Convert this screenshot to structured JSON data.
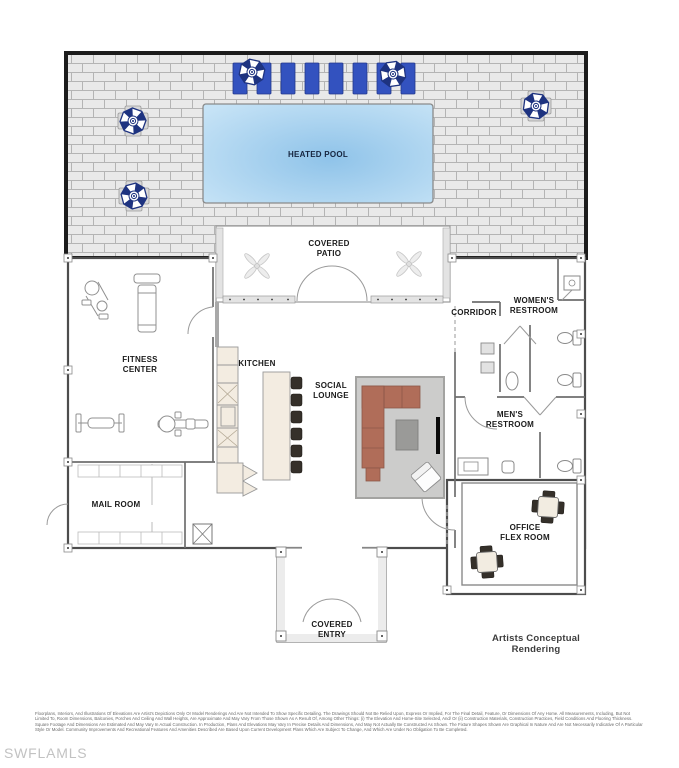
{
  "labels": {
    "heated_pool": "HEATED POOL",
    "covered_patio": "COVERED\nPATIO",
    "fitness_center": "FITNESS\nCENTER",
    "kitchen": "KITCHEN",
    "social_lounge": "SOCIAL\nLOUNGE",
    "corridor": "CORRIDOR",
    "womens_restroom": "WOMEN'S\nRESTROOM",
    "mens_restroom": "MEN'S\nRESTROOM",
    "mail_room": "MAIL ROOM",
    "office_flex_room": "OFFICE\nFLEX ROOM",
    "covered_entry": "COVERED\nENTRY"
  },
  "footer": {
    "rendering_note": "Artists Conceptual Rendering",
    "watermark": "SWFLAMLS",
    "disclaimer": "Floorplans, Interiors, And Illustrations Of Elevations Are Artist's Depictions Only Or Model Renderings And Are Not Intended To Show Specific Detailing. The Drawings Should Not Be Relied Upon, Express Or Implied, For The Final Detail, Feature, Or Dimensions Of Any Home. All Measurements, Including, But Not Limited To, Room Dimensions, Balconies, Porches And Ceiling And Wall Heights, Are Approximate And May Vary From Those Shown As A Result Of, Among Other Things: (i) The Elevation And Home-Site Selected, And/ Or (ii) Construction Materials, Construction Practices, Field Conditions And Flooring Thickness. Square Footage And Dimensions Are Estimated And May Vary In Actual Construction. In Production, Plans And Elevations May Vary In Precise Details And Dimensions, And May Not Actually Be Constructed As Shown. The Fixture Shapes Shown Are Graphical In Nature And Are Not Necessarily Indicative Of A Particular Style Or Model. Community Improvements And Recreational Features And Amenities Described Are Based Upon Current Development Plans Which Are Subject To Change, And Which Are Under No Obligation To Be Completed."
  },
  "colors": {
    "deck_brick": "#e9e9e9",
    "pool_center": "#8fc3e9",
    "pool_edge": "#c6e3f6",
    "lounger_blue": "#3352bf",
    "umbrella_navy": "#1e3380",
    "sofa_terracotta": "#b06d59",
    "rug_gray": "#cccccb",
    "counter_cream": "#f3ece1"
  }
}
